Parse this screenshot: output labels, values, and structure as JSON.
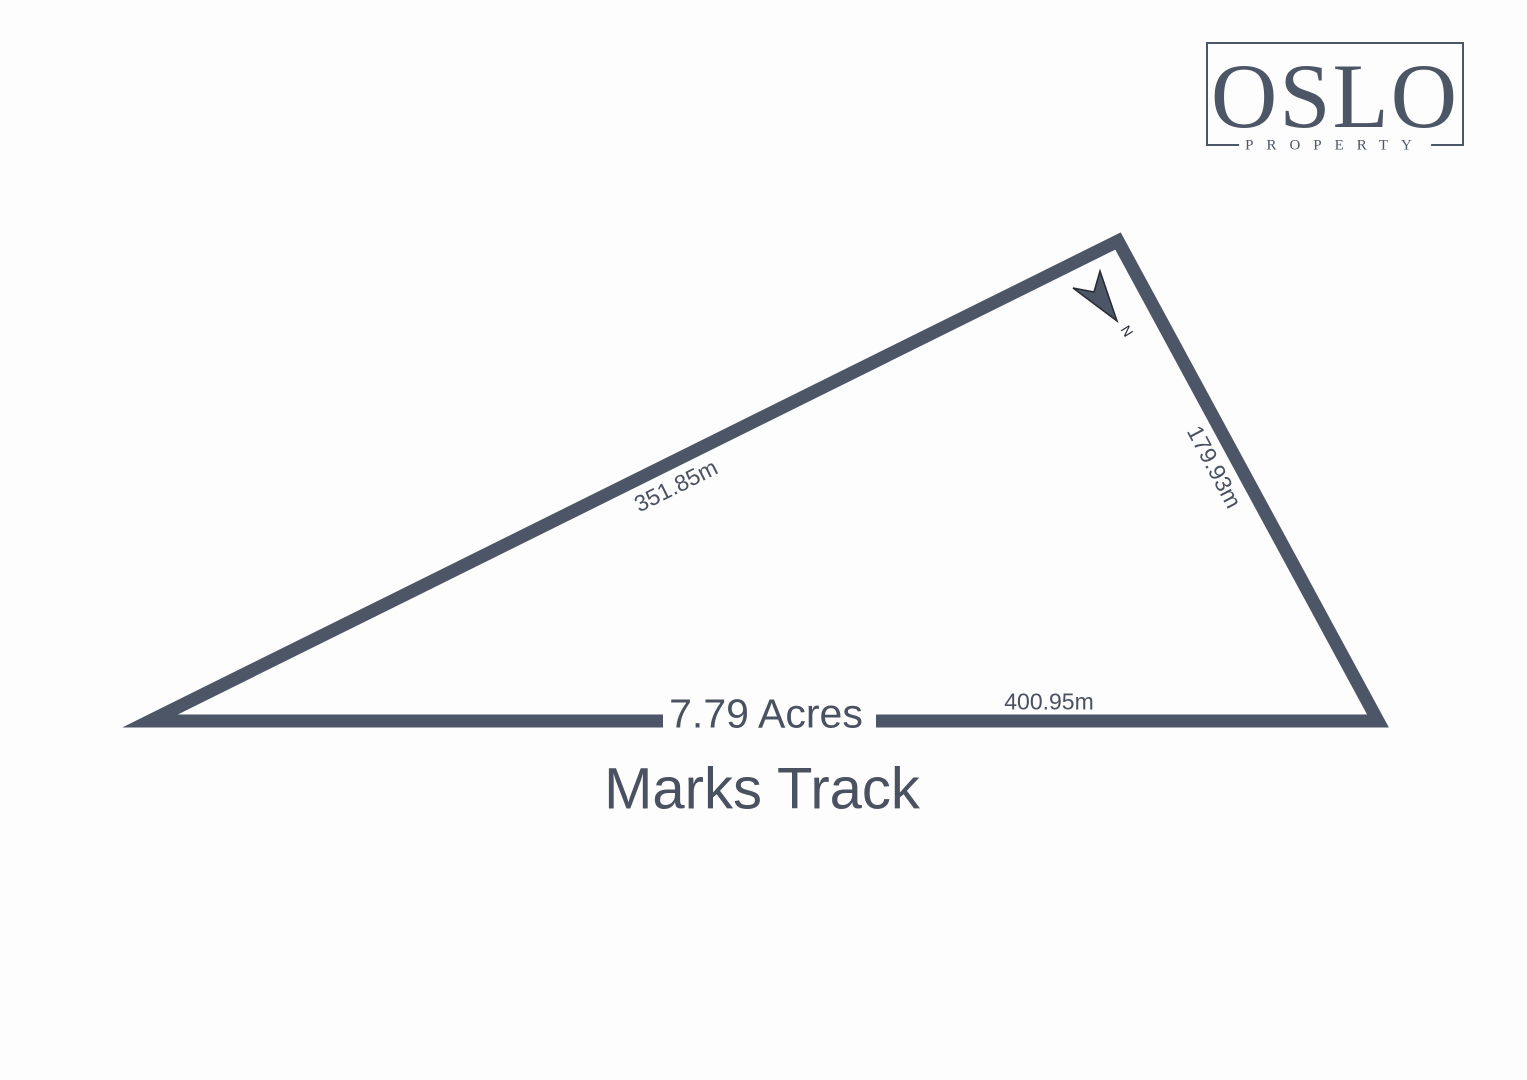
{
  "colors": {
    "slate": "#4d5666",
    "text": "#4a5261",
    "dark": "#262b36",
    "background": "#fdfdfd"
  },
  "logo": {
    "wordmark": "OSLO",
    "subtitle": "PROPERTY"
  },
  "lot": {
    "area": "7.79 Acres",
    "street": "Marks Track",
    "north": "N",
    "sides": {
      "northwest": "351.85m",
      "east": "179.93m",
      "south": "400.95m"
    }
  }
}
